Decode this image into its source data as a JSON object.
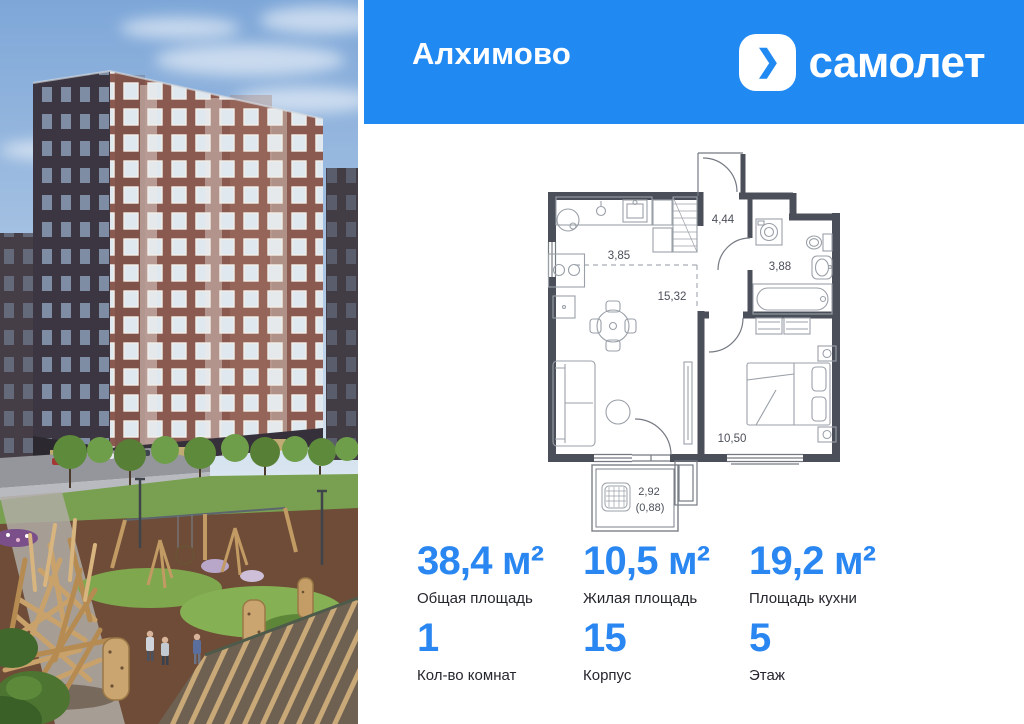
{
  "header": {
    "project_title": "Алхимово",
    "brand": {
      "name": "самолет",
      "chevron": "❯"
    }
  },
  "colors": {
    "header_blue": "#2189f2",
    "stat_blue": "#2a87f1",
    "plan_wall": "#4b4f59"
  },
  "floor_plan": {
    "areas": {
      "kitchen": "3,85",
      "hallway": "4,44",
      "bathroom": "3,88",
      "living": "15,32",
      "bedroom": "10,50",
      "balcony": "2,92",
      "balcony_coef": "(0,88)"
    }
  },
  "stats": {
    "row1": [
      {
        "value": "38,4 м²",
        "label": "Общая площадь"
      },
      {
        "value": "10,5 м²",
        "label": "Жилая площадь"
      },
      {
        "value": "19,2 м²",
        "label": "Площадь кухни"
      }
    ],
    "row2": [
      {
        "value": "1",
        "label": "Кол-во комнат"
      },
      {
        "value": "15",
        "label": "Корпус"
      },
      {
        "value": "5",
        "label": "Этаж"
      }
    ]
  }
}
